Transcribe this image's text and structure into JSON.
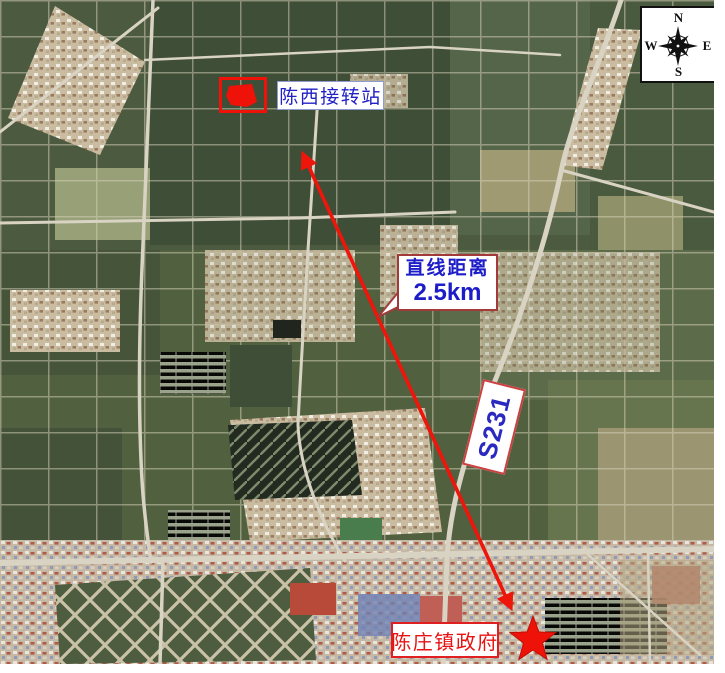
{
  "figure": {
    "type": "satellite-location-map",
    "compass": {
      "north": "N",
      "south": "S",
      "east": "E",
      "west": "W"
    },
    "annotations": {
      "station_label": "陈西接转站",
      "distance_line1": "直线距离",
      "distance_line2": "2.5km",
      "road_label": "S231",
      "government_label": "陈庄镇政府"
    },
    "colors": {
      "annotation_red": "#ee1208",
      "label_blue": "#2121c4",
      "label_red": "#e81414",
      "callout_border": "#a23a3a",
      "compass_ink": "#111111"
    }
  }
}
